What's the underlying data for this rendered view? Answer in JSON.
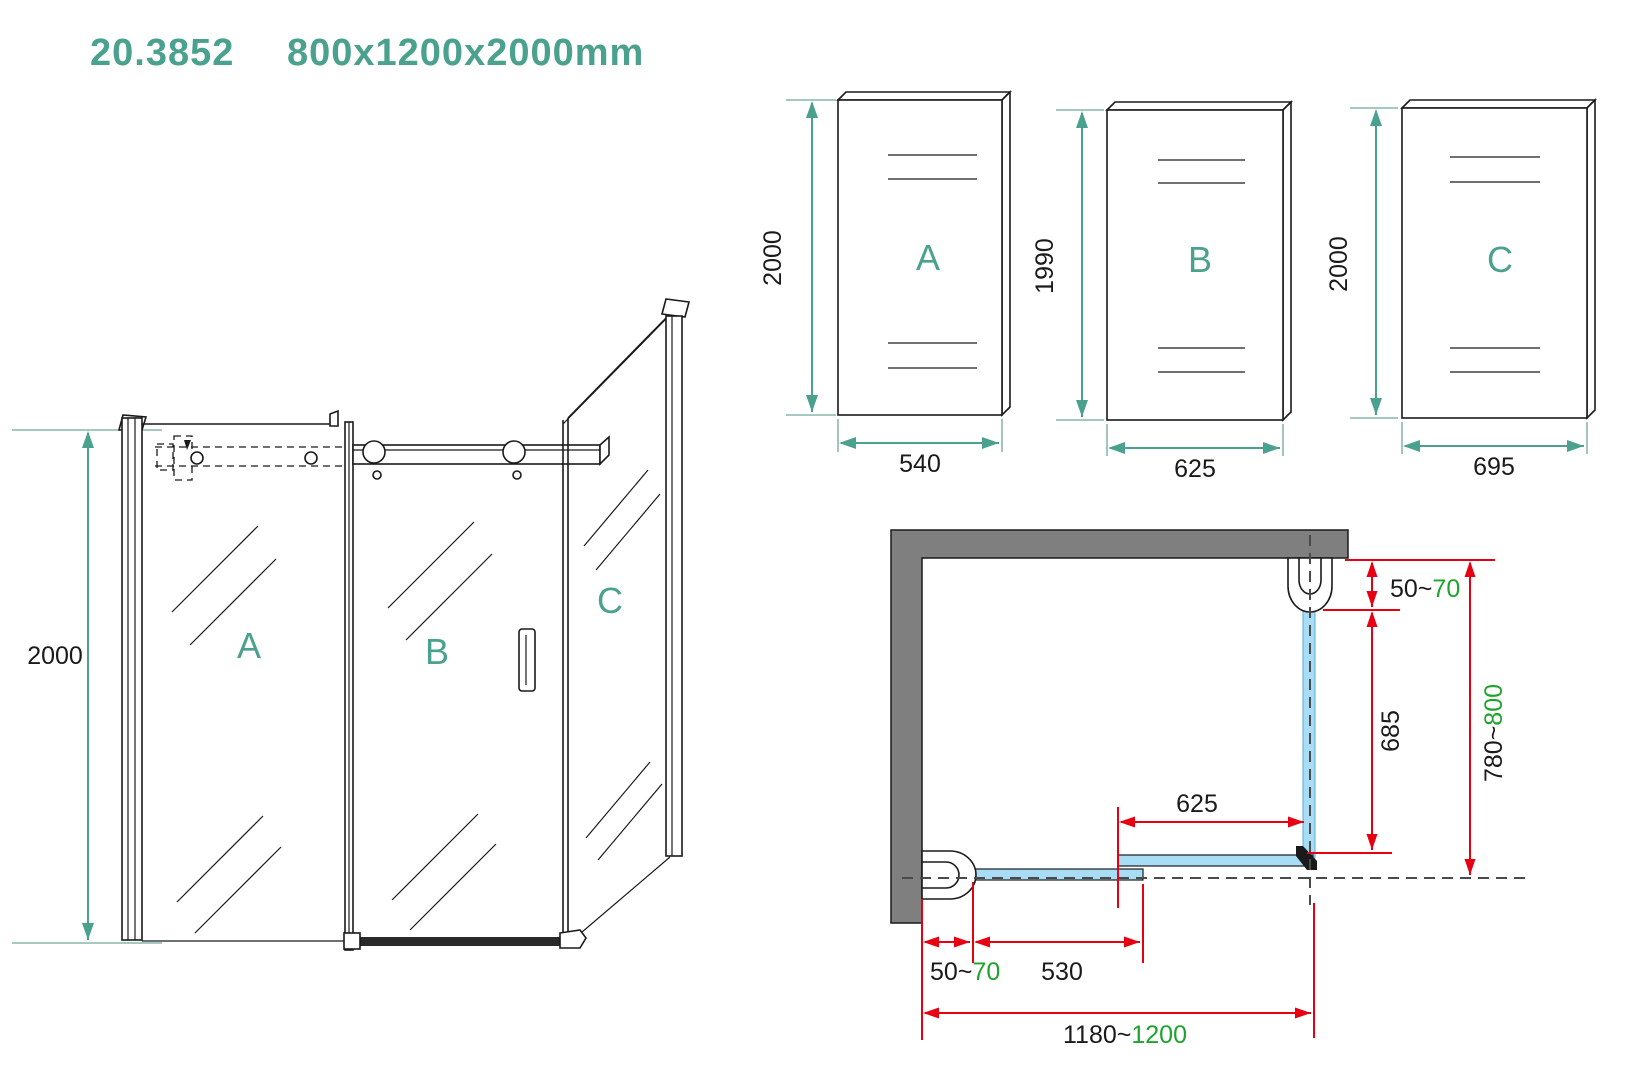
{
  "title": {
    "model_number": "20.3852",
    "dimensions": "800x1200x2000mm"
  },
  "colors": {
    "teal_accent": "#4AA18D",
    "dimension_red": "#E60012",
    "range_green": "#1EA32D",
    "wall_gray": "#7F7F7F",
    "glass_blue": "#A9DCF5",
    "line_black": "#1A1A1A"
  },
  "perspective_view": {
    "height_dim": "2000",
    "labels": {
      "a": "A",
      "b": "B",
      "c": "C"
    }
  },
  "panel_views": [
    {
      "label": "A",
      "height": "2000",
      "width": "540"
    },
    {
      "label": "B",
      "height": "1990",
      "width": "625"
    },
    {
      "label": "C",
      "height": "2000",
      "width": "695"
    }
  ],
  "plan_view": {
    "top_gap": {
      "base": "50~",
      "max": "70"
    },
    "side_glass": "685",
    "side_total": {
      "base": "780~",
      "max": "800"
    },
    "front_fixed": "625",
    "bottom_gap": {
      "base": "50~",
      "max": "70"
    },
    "bottom_door": "530",
    "bottom_total": {
      "base": "1180~",
      "max": "1200"
    }
  }
}
